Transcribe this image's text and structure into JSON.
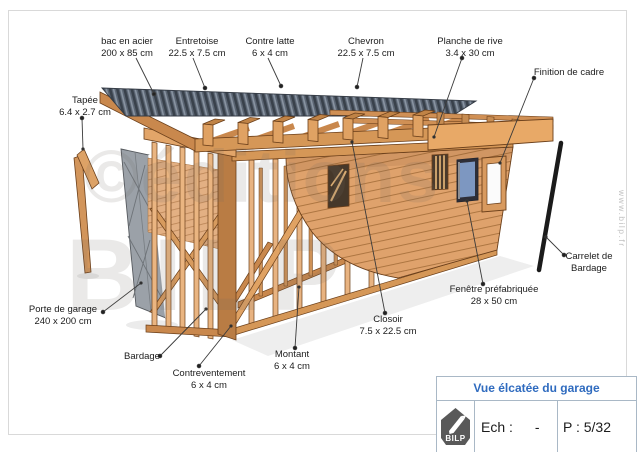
{
  "watermark": {
    "line1": "©éditions",
    "line2": "BILP"
  },
  "side_text": "www.bilp.fr",
  "labels": [
    {
      "id": "bac-en-acier",
      "line1": "bac en acier",
      "line2": "200 x 85 cm"
    },
    {
      "id": "entretoise",
      "line1": "Entretoise",
      "line2": "22.5 x 7.5 cm"
    },
    {
      "id": "contre-latte",
      "line1": "Contre latte",
      "line2": "6 x 4 cm"
    },
    {
      "id": "chevron",
      "line1": "Chevron",
      "line2": "22.5 x 7.5 cm"
    },
    {
      "id": "planche-de-rive",
      "line1": "Planche de rive",
      "line2": "3.4 x 30 cm"
    },
    {
      "id": "finition-de-cadre",
      "line1": "Finition de cadre"
    },
    {
      "id": "tapee",
      "line1": "Tapée",
      "line2": "6.4 x 2.7 cm"
    },
    {
      "id": "porte-de-garage",
      "line1": "Porte de garage",
      "line2": "240 x 200 cm"
    },
    {
      "id": "bardage",
      "line1": "Bardage"
    },
    {
      "id": "contreventement",
      "line1": "Contreventement",
      "line2": "6 x 4 cm"
    },
    {
      "id": "montant",
      "line1": "Montant",
      "line2": "6 x 4 cm"
    },
    {
      "id": "closoir",
      "line1": "Closoir",
      "line2": "7.5 x 22.5 cm"
    },
    {
      "id": "fenetre-prefabriquee",
      "line1": "Fenêtre préfabriquée",
      "line2": "28 x 50 cm"
    },
    {
      "id": "carrelet-de-bardage",
      "line1": "Carrelet de",
      "line2": "Bardage"
    }
  ],
  "title_block": {
    "title": "Vue élcatée du garage",
    "logo_text": "BILP",
    "scale_label": "Ech :",
    "scale_value": "-",
    "page_label": "P : 5/32"
  },
  "colors": {
    "accent_blue": "#2f6bbf",
    "wood_light": "#e8b381",
    "wood_mid": "#d59757",
    "wood_dark": "#b97c44",
    "steel_deck": "#5b6573",
    "door_gray": "#9ba1a8",
    "glass_blue": "#7d97c1",
    "titleblock_border": "#a9b8c6"
  }
}
